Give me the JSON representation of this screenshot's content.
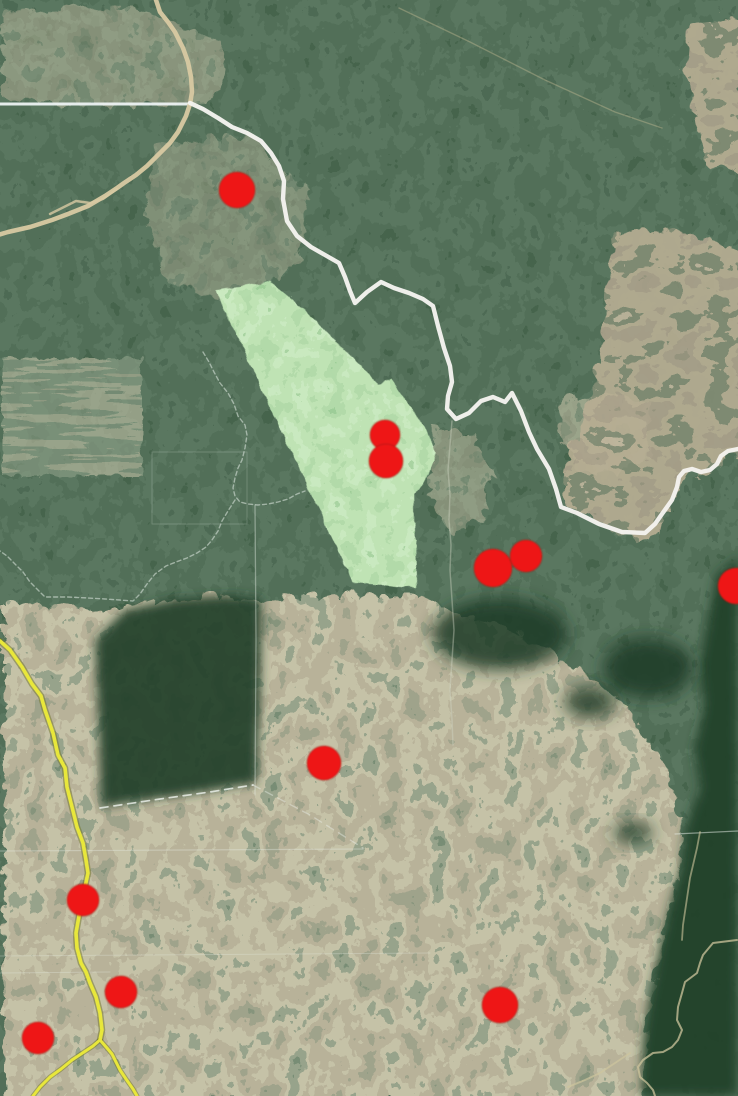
{
  "map": {
    "width": 738,
    "height": 1096,
    "colors": {
      "forest_base": "#2c4733",
      "marker_red": "#ee1212",
      "protected_area_green": "#7cc16d",
      "river_white": "#f4f3ee",
      "highway_yellow": "#e8e73b",
      "road_tan": "#d8c9a2",
      "boundary_white": "#edf2f3",
      "stream_tan": "#cdc49c"
    },
    "features": [
      {
        "name": "survey-line-1",
        "kind": "polyline",
        "pts": "0,851 363,849",
        "stroke": "#e9efe9",
        "w": 1.2,
        "op": 0.35
      },
      {
        "name": "survey-line-2",
        "kind": "polyline",
        "pts": "0,956 430,953",
        "stroke": "#e9efe9",
        "w": 1,
        "op": 0.28
      },
      {
        "name": "survey-line-3",
        "kind": "polyline",
        "pts": "0,973 110,972",
        "stroke": "#e9efe9",
        "w": 1,
        "op": 0.3
      },
      {
        "name": "survey-line-4",
        "kind": "polyline",
        "pts": "675,834 738,831",
        "stroke": "#e9efe9",
        "w": 1.2,
        "op": 0.5
      },
      {
        "name": "cadastral-vertical-line",
        "kind": "polyline",
        "pts": "255,505 256,640 255,795",
        "stroke": "#e9efe9",
        "w": 1.3,
        "op": 0.4
      },
      {
        "name": "field-grid-outline",
        "kind": "polyline",
        "pts": "152,452 247,452 247,524 152,524 152,452",
        "stroke": "#e9efe9",
        "w": 1,
        "op": 0.2
      },
      {
        "name": "admin-boundary-north",
        "kind": "polyline",
        "pts": "203,352 209,362 214,372 220,383 228,393 234,404 238,416 245,425 247,435 245,448 242,460 238,468 235,478 233,488 235,496 240,502 248,504 258,505 268,504 278,502 288,499 297,494 305,491",
        "stroke": "#e2ebe4",
        "w": 1.4,
        "op": 0.55,
        "dash": "4 3"
      },
      {
        "name": "admin-boundary-south",
        "kind": "polyline",
        "pts": "235,500 228,511 222,521 218,531 212,540 206,547 197,553 187,558 176,562 166,566 155,574 147,584 140,594 133,601 120,600 105,599 88,598 68,597 45,597 38,590 30,582 23,572 16,565 7,556 0,551",
        "stroke": "#e2ebe4",
        "w": 1.4,
        "op": 0.55,
        "dash": "4 3"
      },
      {
        "name": "forest-dashed-boundary",
        "kind": "polyline",
        "pts": "100,808 160,799 210,792 253,785",
        "stroke": "#edf2ed",
        "w": 1.7,
        "op": 0.8,
        "dash": "8 6"
      },
      {
        "name": "forest-dashed-boundary-ext",
        "kind": "polyline",
        "pts": "253,785 310,815 363,848",
        "stroke": "#edf2ed",
        "w": 1.4,
        "op": 0.4,
        "dash": "8 6"
      },
      {
        "name": "state-boundary-line",
        "kind": "polyline",
        "pts": "0,104 190,104",
        "stroke": "#edf2f3",
        "w": 3,
        "op": 0.95
      },
      {
        "name": "forest-trail",
        "kind": "polyline",
        "pts": "399,8 470,42 545,80 615,112 662,128",
        "stroke": "#c9bd96",
        "w": 1.4,
        "op": 0.4
      },
      {
        "name": "dirt-road-spur",
        "kind": "polyline",
        "pts": "117,189 103,199 90,203 76,201 64,207 50,214",
        "stroke": "#d8c9a2",
        "w": 2.4,
        "op": 0.8
      },
      {
        "name": "dirt-road",
        "kind": "polyline",
        "pts": "155,-3 160,12 168,22 175,32 183,48 188,62 191,77 192,92 190,104 186,116 178,132 170,143 158,155 147,166 136,175 124,183 117,188 105,196 88,206 68,214 52,220 30,227 8,232 -2,235",
        "stroke": "#d8c9a2",
        "w": 4.5,
        "op": 0.95
      },
      {
        "name": "stream-south",
        "kind": "polyline",
        "pts": "452,421 450,445 448,470 450,495 449,520 451,545 450,570 452,600 454,630 452,660 450,690 452,720 453,745",
        "stroke": "#d2d6c6",
        "w": 1.5,
        "op": 0.4
      },
      {
        "name": "highway-casing",
        "kind": "polyline",
        "pts": "0,641 10,650 22,667 32,684 41,696 45,710 53,733 58,755 65,768 67,787 72,807 77,827 83,843 86,860 88,873 85,887 83,900 79,916 76,933 77,948 81,963 86,972 90,983 96,997 100,1013 102,1030 100,1040",
        "stroke": "#6f7426",
        "w": 6.5,
        "op": 0.5
      },
      {
        "name": "highway-casing-branch-left",
        "kind": "polyline",
        "pts": "100,1040 93,1046 84,1052 72,1060 61,1069 50,1077 40,1087 33,1096",
        "stroke": "#6f7426",
        "w": 5,
        "op": 0.5
      },
      {
        "name": "highway-casing-branch-right",
        "kind": "polyline",
        "pts": "100,1040 107,1048 112,1054 116,1062 120,1070 126,1079 133,1089 137,1096",
        "stroke": "#6f7426",
        "w": 5,
        "op": 0.5
      },
      {
        "name": "highway",
        "kind": "polyline",
        "pts": "0,641 10,650 22,667 32,684 41,696 45,710 53,733 58,755 65,768 67,787 72,807 77,827 83,843 86,860 88,873 85,887 83,900 79,916 76,933 77,948 81,963 86,972 90,983 96,997 100,1013 102,1030 100,1040",
        "stroke": "#e8e73b",
        "w": 3.6,
        "op": 1
      },
      {
        "name": "highway-branch-left",
        "kind": "polyline",
        "pts": "100,1040 93,1046 84,1052 72,1060 61,1069 50,1077 40,1087 33,1096",
        "stroke": "#e8e73b",
        "w": 3,
        "op": 1
      },
      {
        "name": "highway-branch-right",
        "kind": "polyline",
        "pts": "100,1040 107,1048 112,1054 116,1062 120,1070 126,1079 133,1089 137,1096",
        "stroke": "#e8e73b",
        "w": 3,
        "op": 1
      },
      {
        "name": "protected-area-polygon",
        "kind": "polygon",
        "pts": "215,290 269,281 311,316 377,383 390,377 408,404 424,429 435,451 429,470 413,494 415,588 352,581",
        "fill": "#7cc16d",
        "filter": "green",
        "stroke": "rgba(70,115,55,0.5)",
        "w": 1,
        "op": 0.96,
        "interactable": true
      },
      {
        "name": "river",
        "kind": "polyline",
        "pts": "190,103 203,109 218,118 232,127 247,133 261,141 271,153 279,166 284,181 283,199 287,221 297,236 311,247 325,255 339,263 345,277 350,291 355,303 367,292 381,282 394,288 409,293 423,299 433,306 438,326 444,348 450,366 452,382 448,396 447,409 456,419 469,413 481,401 493,397 505,402 512,393 521,411 529,432 537,449 549,469 556,489 561,507 577,513 599,524 622,532 645,533 655,524 662,514 672,500 677,487 679,477 684,471 692,469 701,472 710,470 717,464 721,456 728,451 738,449",
        "stroke": "#f4f3ee",
        "w": 4.4,
        "op": 0.97
      },
      {
        "name": "stream-tan-upper",
        "kind": "polyline",
        "pts": "700,832 697,848 690,878 686,905 683,925 682,940",
        "stroke": "#cdc49c",
        "w": 1.8,
        "op": 0.6
      },
      {
        "name": "stream-tan",
        "kind": "polyline",
        "pts": "737,940 713,943 703,955 700,963 697,973 685,982 682,993 678,1007 677,1020 682,1030 678,1040 672,1047 663,1052 653,1053 643,1060 638,1067 640,1077 647,1083 653,1090 655,1096",
        "stroke": "#cdc49c",
        "w": 2,
        "op": 0.75
      },
      {
        "name": "stream-tan-branch",
        "kind": "polyline",
        "pts": "630,1053 615,1063 600,1073 585,1080 568,1087",
        "stroke": "#cdc49c",
        "w": 1.8,
        "op": 0.7
      }
    ],
    "markers": [
      {
        "name": "alert-marker-1",
        "x": 237,
        "y": 190,
        "r": 18
      },
      {
        "name": "alert-marker-2a",
        "x": 385,
        "y": 435,
        "r": 15
      },
      {
        "name": "alert-marker-2b",
        "x": 386,
        "y": 461,
        "r": 17
      },
      {
        "name": "alert-marker-3",
        "x": 493,
        "y": 568,
        "r": 19
      },
      {
        "name": "alert-marker-4",
        "x": 526,
        "y": 556,
        "r": 16
      },
      {
        "name": "alert-marker-5",
        "x": 736,
        "y": 586,
        "r": 18
      },
      {
        "name": "alert-marker-6",
        "x": 324,
        "y": 763,
        "r": 17
      },
      {
        "name": "alert-marker-7",
        "x": 83,
        "y": 900,
        "r": 16
      },
      {
        "name": "alert-marker-8",
        "x": 121,
        "y": 992,
        "r": 16
      },
      {
        "name": "alert-marker-9",
        "x": 38,
        "y": 1038,
        "r": 16
      },
      {
        "name": "alert-marker-10",
        "x": 500,
        "y": 1005,
        "r": 18
      }
    ]
  }
}
